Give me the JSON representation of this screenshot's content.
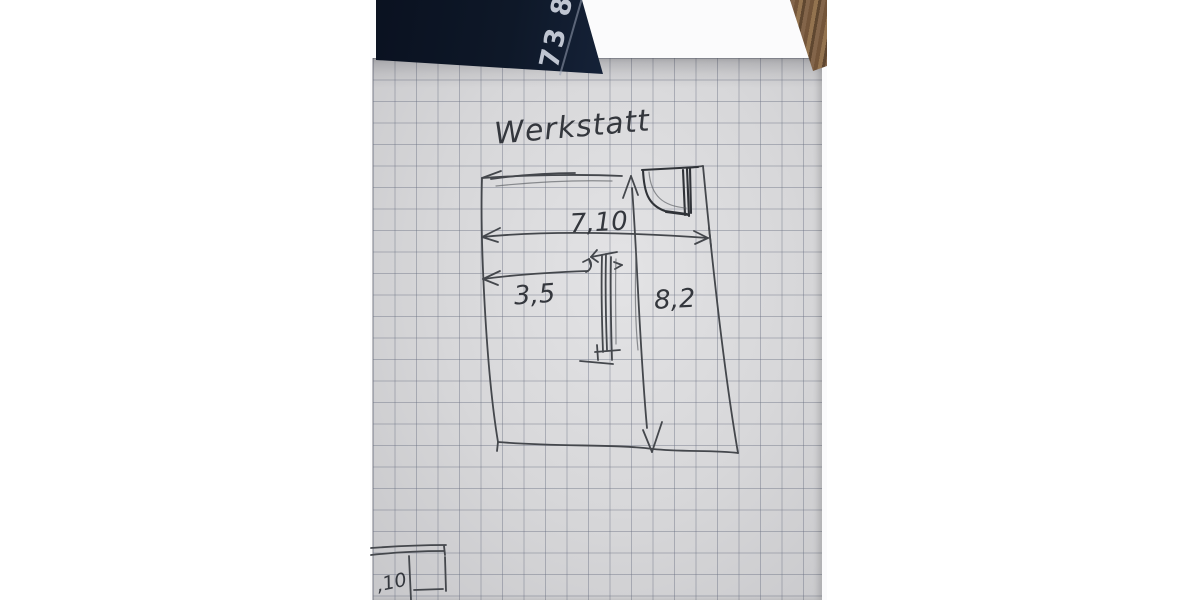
{
  "photo": {
    "sketch": {
      "title": "Werkstatt",
      "dim_total_width": "7,10",
      "dim_partial_width": "3,5",
      "dim_height": "8,2",
      "corner_fragment_dim": ",10"
    },
    "background_objects": {
      "folder_number": "73 8"
    },
    "colors": {
      "page_margin": "#ffffff",
      "paper": "#d7d7d9",
      "grid_line": "#9da3b0",
      "pencil": "#44474c",
      "navy_folder": "#0e1828",
      "brown_object": "#2a1d12",
      "wood_table": "#84664a"
    }
  }
}
